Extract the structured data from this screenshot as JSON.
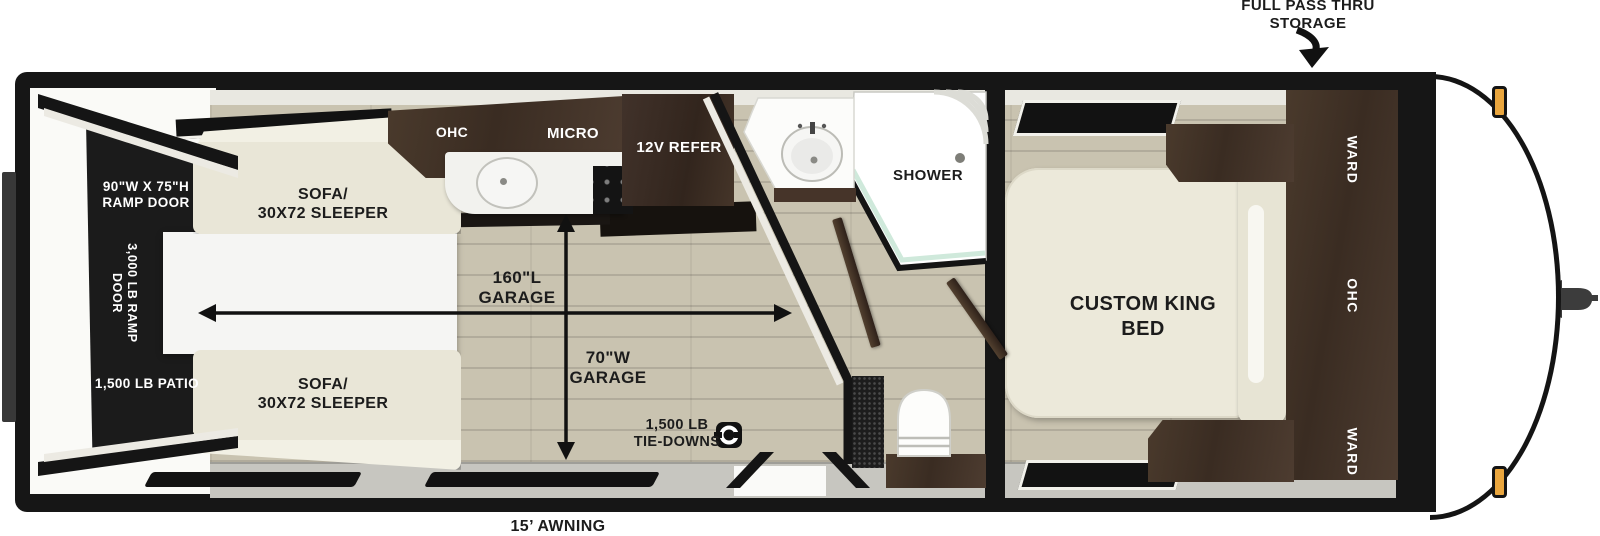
{
  "annotations": {
    "pass_thru_line1": "FULL PASS THRU",
    "pass_thru_line2": "STORAGE",
    "awning": "15’ AWNING"
  },
  "rear": {
    "ramp_size_line1": "90\"W X 75\"H",
    "ramp_size_line2": "RAMP DOOR",
    "ramp_rating_line1": "3,000 LB RAMP",
    "ramp_rating_line2": "DOOR",
    "patio": "1,500 LB PATIO"
  },
  "garage": {
    "sofa_line1": "SOFA/",
    "sofa_line2": "30X72 SLEEPER",
    "length_line1": "160\"L",
    "length_line2": "GARAGE",
    "width_line1": "70\"W",
    "width_line2": "GARAGE",
    "tiedowns_line1": "1,500 LB",
    "tiedowns_line2": "TIE-DOWNS"
  },
  "kitchen": {
    "ohc": "OHC",
    "micro": "MICRO",
    "refer": "12V REFER"
  },
  "bath": {
    "shower": "SHOWER"
  },
  "bedroom": {
    "bed_line1": "CUSTOM KING",
    "bed_line2": "BED",
    "ward_top": "WARD",
    "ohc": "OHC",
    "ward_bottom": "WARD"
  },
  "colors": {
    "wall": "#161616",
    "floor": "#c9c3b0",
    "cabinet": "#46352b",
    "sofa": "#e9e6d7",
    "shower_glass": "#cfe9db",
    "marker_light": "#eaa63e"
  }
}
